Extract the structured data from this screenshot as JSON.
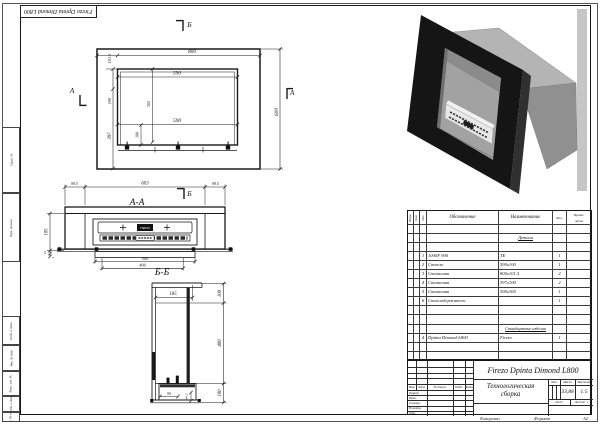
{
  "palette": {
    "ink": "#1a1a1a",
    "fireplace_black": "#151515",
    "housing_grey": "#b4b4b4",
    "backdrop_grey": "#c6c6c6"
  },
  "sheet": {
    "corner_stamp": "Firezo Dpinta Dimond L800",
    "margin_labels": [
      "Справ. №",
      "Перв. примен.",
      "Подп. и дата",
      "Инв. № дубл.",
      "Взам. инв. №",
      "Подп. и дата",
      "Инв. № подл."
    ],
    "footer": {
      "copied": "Копировал",
      "format_label": "Формат",
      "format_value": "А2"
    }
  },
  "views": {
    "front": {
      "marker_top": "Б",
      "marker_left": "А",
      "marker_right": "А",
      "d800": "800",
      "d101_5": "101.5",
      "d590_top": "590",
      "d590_bot": "590",
      "d600": "600",
      "d100_left": "100",
      "d397": "397",
      "d365": "365",
      "d100_inner": "100"
    },
    "aa": {
      "title": "А-А",
      "marker": "Б",
      "d98_5_l": "98.5",
      "d603": "603",
      "d98_5_r": "98.5",
      "d500": "500",
      "d406": "406",
      "d185": "185",
      "d15": "15",
      "d5": "5",
      "burner_label": "FIREZO"
    },
    "bb": {
      "title": "Б-Б",
      "d185": "185",
      "d100_top": "100",
      "d400": "400",
      "d100_bot": "100",
      "d90": "90",
      "d40_5": "40.5"
    }
  },
  "spec": {
    "col_format": "Форм.",
    "col_zone": "Зона",
    "col_pos": "Поз.",
    "col_designation": "Обозначение",
    "col_name": "Наименование",
    "col_qty": "Кол.",
    "col_note": "Приме-\nчание",
    "section_details": "Детали",
    "section_standard": "Стандартные изделия",
    "rows": [
      {
        "pos": "1",
        "designation": "1000F 900",
        "name": "ТЕ",
        "qty": "1"
      },
      {
        "pos": "2",
        "designation": "Стекло",
        "name": "590х100",
        "qty": "1"
      },
      {
        "pos": "3",
        "designation": "Стемалит",
        "name": "800х101.5",
        "qty": "2"
      },
      {
        "pos": "4",
        "designation": "Стемалит",
        "name": "397х100",
        "qty": "2"
      },
      {
        "pos": "5",
        "designation": "Стемалит",
        "name": "590х365",
        "qty": "1"
      },
      {
        "pos": "6",
        "designation": "Стеклодержатель",
        "name": "",
        "qty": "1"
      }
    ],
    "std_rows": [
      {
        "pos": "4",
        "designation": "Dpinta Dimond-L800",
        "name": "Firezo",
        "qty": "1"
      }
    ]
  },
  "title_block": {
    "doc_name": "Firezo Dpinta Dimond L800",
    "type_line1": "Технологическая",
    "type_line2": "сборка",
    "lit_label": "Лит.",
    "mass_label": "Масса",
    "scale_label": "Масштаб",
    "mass_value": "33,88",
    "scale_value": "1:5",
    "sheet_label": "Лист",
    "sheets_label": "Листов",
    "sheets_value": "1",
    "rev_headers": [
      "Изм.",
      "Лист",
      "№ докум.",
      "Подп.",
      "Дата"
    ],
    "sign_rows": [
      "Разраб.",
      "Пров.",
      "Т.контр.",
      "Н.контр.",
      "Утв."
    ]
  }
}
